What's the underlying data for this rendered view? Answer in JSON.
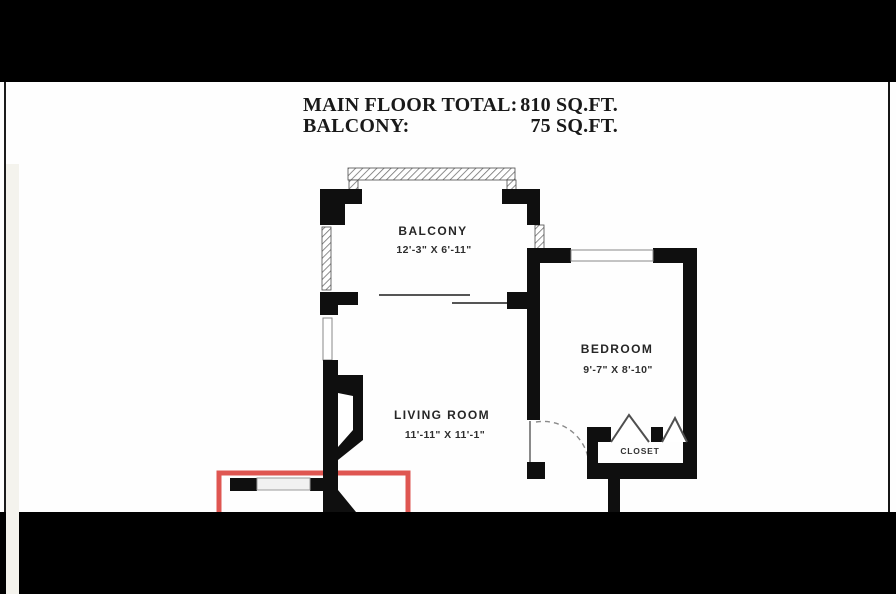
{
  "header": {
    "rows": [
      {
        "label": "MAIN FLOOR TOTAL:",
        "value": "810 SQ.FT."
      },
      {
        "label": "BALCONY:",
        "value": "75 SQ.FT."
      }
    ]
  },
  "floorplan": {
    "rooms": [
      {
        "name": "BALCONY",
        "dims": "12'-3\" X 6'-11\""
      },
      {
        "name": "BEDROOM",
        "dims": "9'-7\" X 8'-10\""
      },
      {
        "name": "LIVING ROOM",
        "dims": "11'-11\" X 11'-1\""
      },
      {
        "name": "CLOSET",
        "dims": ""
      }
    ],
    "colors": {
      "wall": "#0f0f0f",
      "highlight": "#df5651",
      "hatch_line": "#6f6f6f"
    }
  }
}
